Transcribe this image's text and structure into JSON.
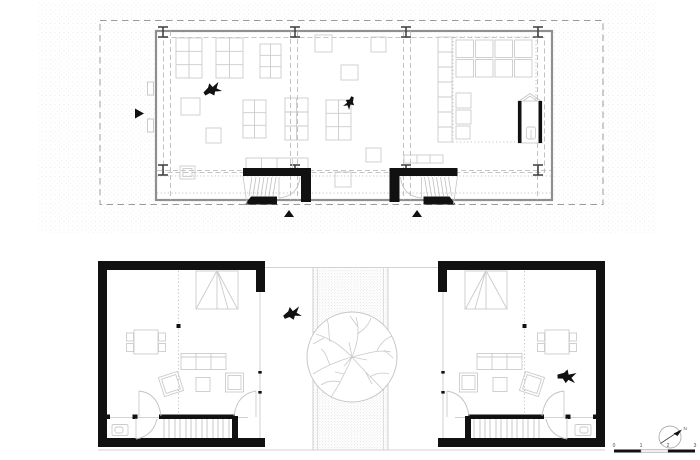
{
  "colors": {
    "paper": "#ffffff",
    "ink": "#111111",
    "wall_gray": "#8f8f8f",
    "light_line": "#cbcbcb",
    "dash_line": "#b3b3b3",
    "stipple": "#dedede",
    "stipple_dense": "#c9c9c9",
    "scale_mid_fill": "#eeeeee"
  },
  "scale_bar": {
    "labels": [
      "0",
      "1",
      "2",
      "3"
    ]
  },
  "north_indicator": {
    "label": "N"
  },
  "icons": {
    "bird": "bird-silhouette-icon",
    "tree": "tree-canopy-icon",
    "column": "i-beam-column-icon",
    "entrance_marker": "solid-triangle-arrow-icon",
    "north": "north-arrow-icon"
  },
  "counts": {
    "birds_upper_plan": 2,
    "birds_lower_plan": 2,
    "columns": 8,
    "stairs_upper_plan": 2,
    "stairs_lower_plan": 2,
    "trees": 1
  }
}
